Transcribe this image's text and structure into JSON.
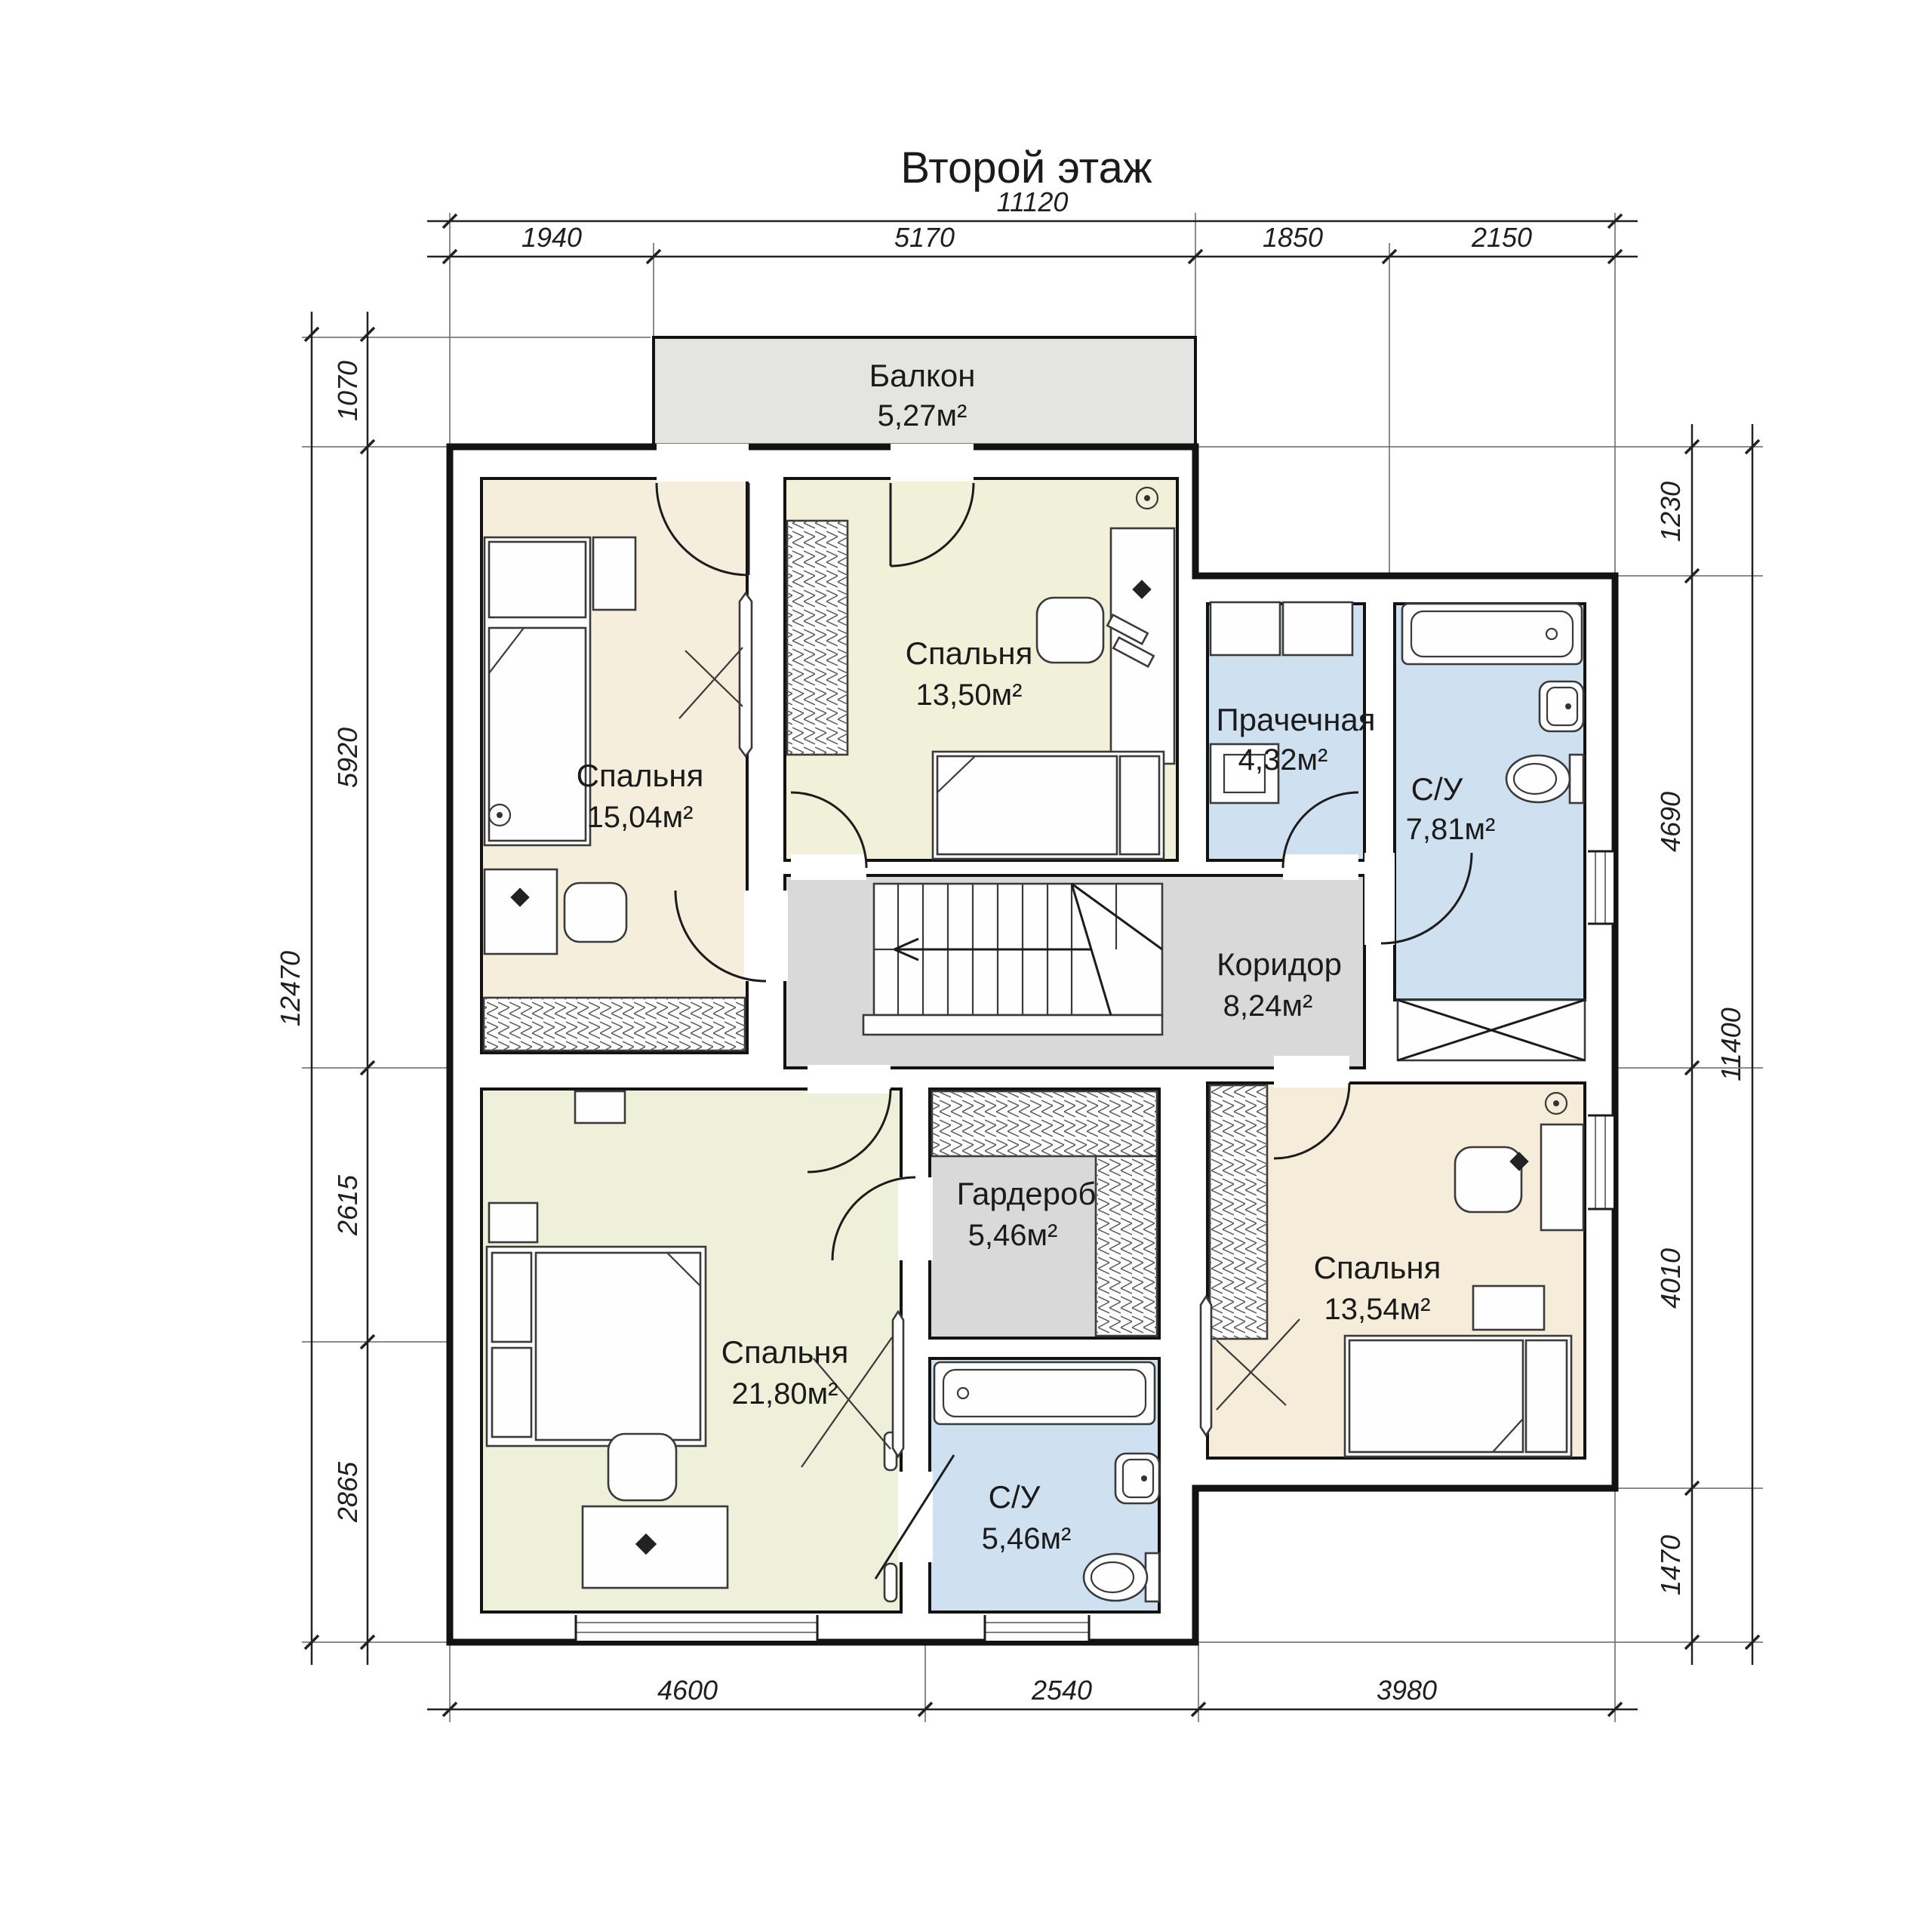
{
  "title": "Второй этаж",
  "rooms": {
    "balcony": {
      "name": "Балкон",
      "area": "5,27м²"
    },
    "bedroom_top_left": {
      "name": "Спальня",
      "area": "15,04м²"
    },
    "bedroom_top_middle": {
      "name": "Спальня",
      "area": "13,50м²"
    },
    "laundry": {
      "name": "Прачечная",
      "area": "4,32м²"
    },
    "bathroom_top": {
      "name": "С/У",
      "area": "7,81м²"
    },
    "corridor": {
      "name": "Коридор",
      "area": "8,24м²"
    },
    "wardrobe": {
      "name": "Гардероб",
      "area": "5,46м²"
    },
    "bedroom_bottom_left": {
      "name": "Спальня",
      "area": "21,80м²"
    },
    "bathroom_bottom": {
      "name": "С/У",
      "area": "5,46м²"
    },
    "bedroom_bottom_right": {
      "name": "Спальня",
      "area": "13,54м²"
    }
  },
  "dimensions": {
    "top_total": "11120",
    "top_segments": [
      "1940",
      "5170",
      "1850",
      "2150"
    ],
    "bottom_segments": [
      "4600",
      "2540",
      "3980"
    ],
    "left_total": "12470",
    "left_segments": [
      "1070",
      "5920",
      "2615",
      "2865"
    ],
    "right_total": "11400",
    "right_segments": [
      "1230",
      "4690",
      "4010",
      "1470"
    ]
  },
  "colors": {
    "bedroom_beige": "#f6eedd",
    "bedroom_cream": "#f1f0d8",
    "wet_blue": "#cfe1f0",
    "hall_gray": "#d9d9d9",
    "balcony_gray": "#e4e4e2",
    "wall_black": "#121212"
  }
}
